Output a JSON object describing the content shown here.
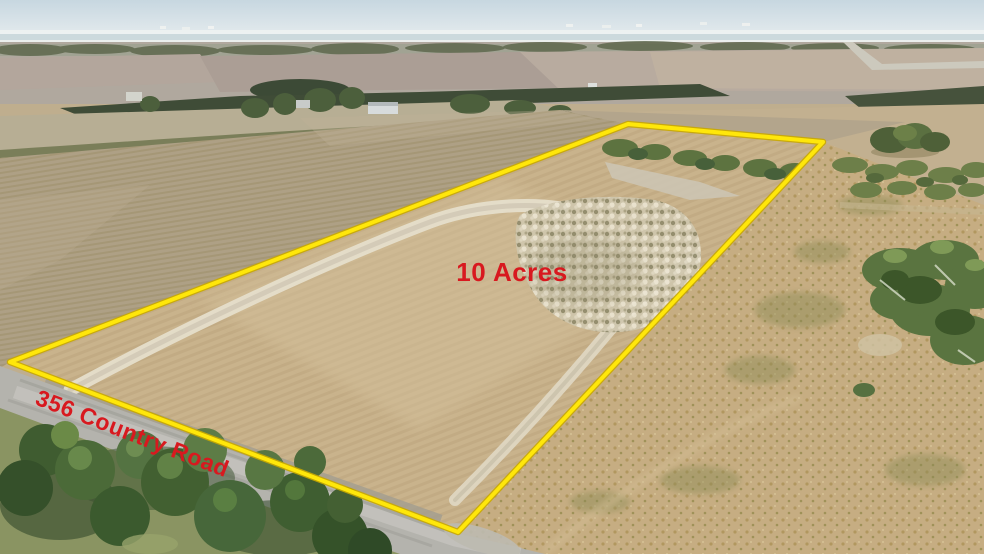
{
  "photo": {
    "kind": "aerial-drone-photograph",
    "subject": "10 acre farmland parcel outlined for sale along a country road"
  },
  "labels": {
    "acreage": "10 Acres",
    "road_name": "356 Country Road"
  },
  "colors": {
    "boundary_yellow": "#ffe70a",
    "boundary_yellow_edge": "#c9a900",
    "label_red": "#d8191f",
    "sky": "#cfdde4",
    "parcel_field_tan": "#c9b38c",
    "neighbor_plowed_field": "#aea085",
    "pasture_gold": "#c6ad82",
    "tree_green": "#4b6a38",
    "road_gray": "#b4b3ad",
    "caliche_white": "#e6dfcd"
  }
}
